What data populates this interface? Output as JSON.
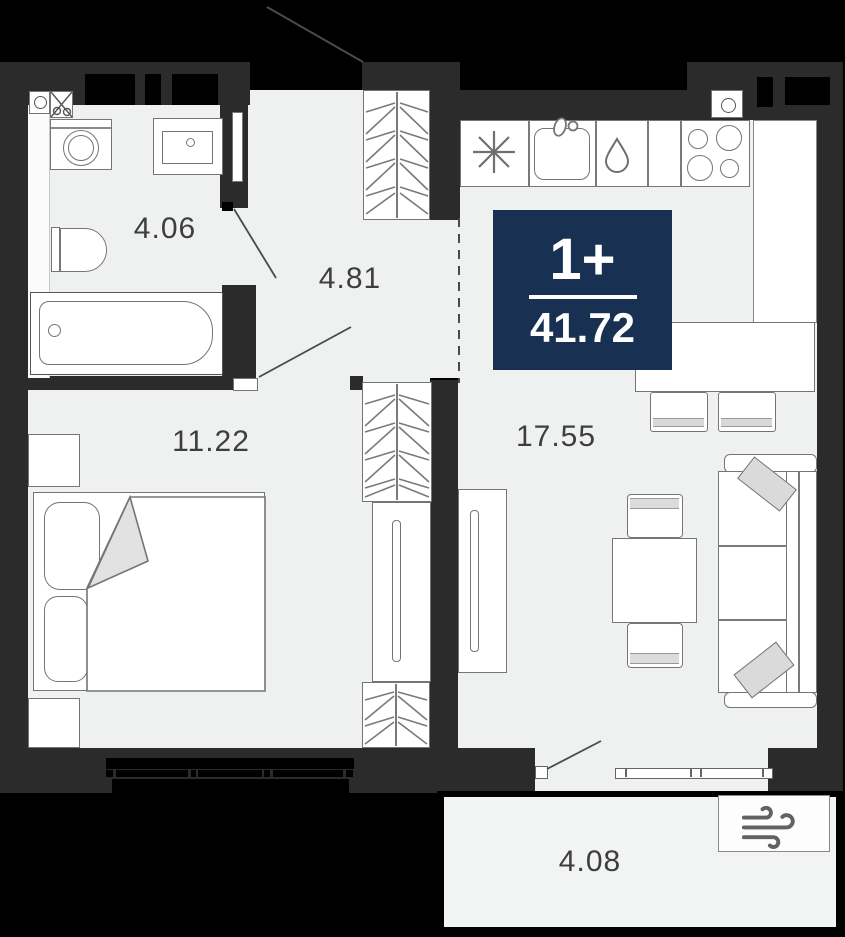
{
  "floorplan": {
    "badge": {
      "unit_type": "1+",
      "total_area": "41.72"
    },
    "rooms": {
      "bathroom": {
        "label": "4.06"
      },
      "hallway": {
        "label": "4.81"
      },
      "bedroom": {
        "label": "11.22"
      },
      "living_kitchen": {
        "label": "17.55"
      },
      "balcony": {
        "label": "4.08"
      }
    },
    "colors": {
      "background": "#000000",
      "wall": "#2b2b2b",
      "floor": "#eff0f0",
      "badge_bg": "#183052",
      "outline": "#757575"
    },
    "icons": [
      "snowflake-icon",
      "water-drop-icon",
      "burners-icon",
      "wind-icon"
    ]
  }
}
